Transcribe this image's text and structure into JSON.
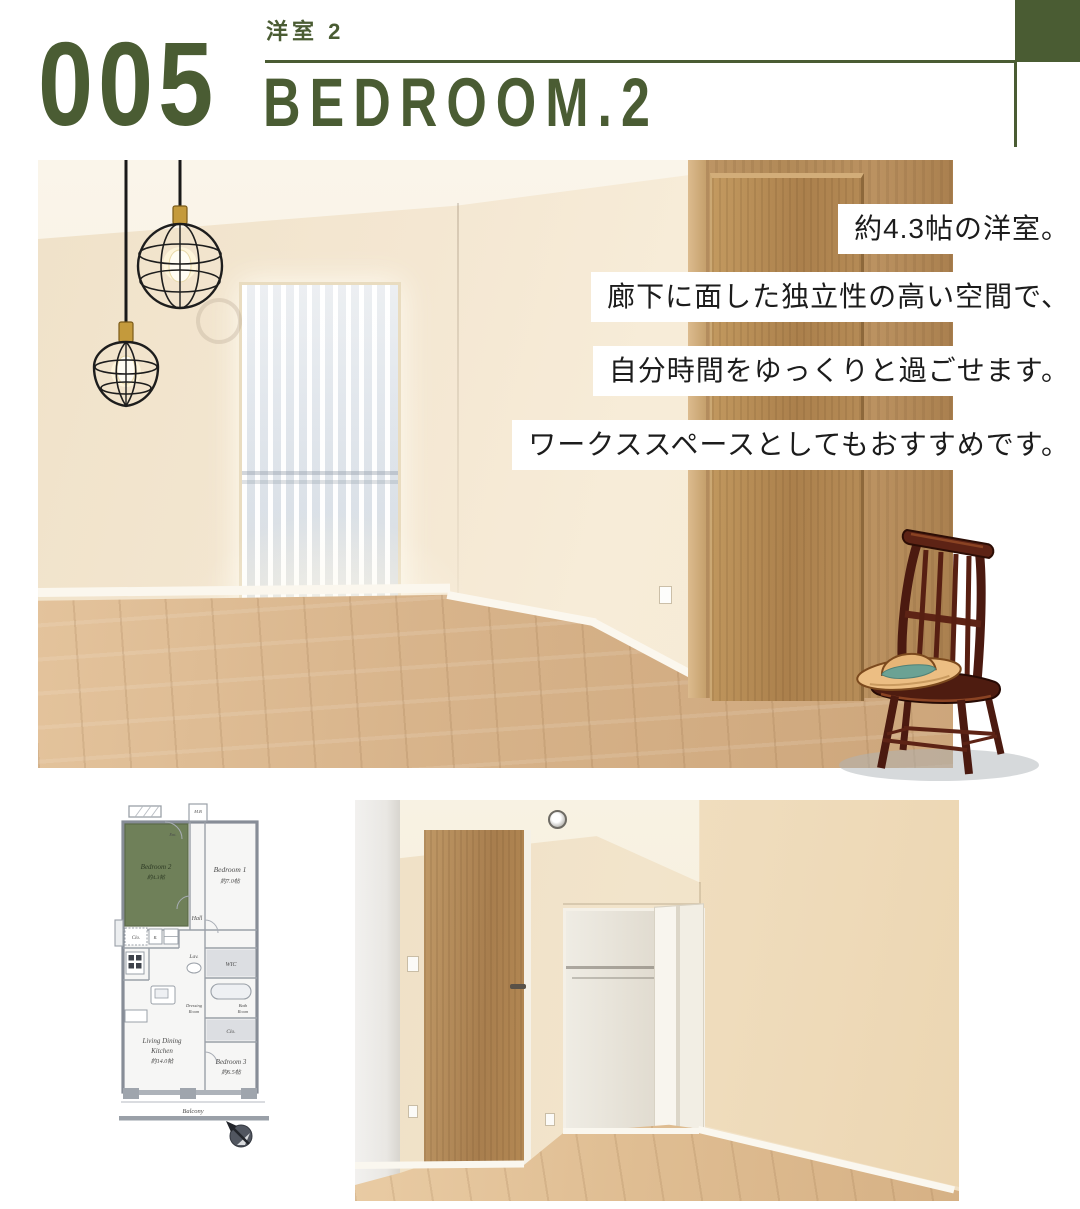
{
  "header": {
    "number": "005",
    "subtitle_jp": "洋室 2",
    "title_en": "BEDROOM.2",
    "accent_color": "#4a5c33"
  },
  "captions": {
    "lines": [
      "約4.3帖の洋室。",
      "廊下に面した独立性の高い空間で、",
      "自分時間をゆっくりと過ごせます。",
      "ワークススペースとしてもおすすめです。"
    ]
  },
  "floorplan": {
    "bedroom2_name": "Bedroom 2",
    "bedroom2_size": "約4.3帖",
    "bedroom1_name": "Bedroom 1",
    "bedroom1_size": "約7.0帖",
    "bedroom3_name": "Bedroom 3",
    "bedroom3_size": "約6.5帖",
    "ldk_name_1": "Living Dining",
    "ldk_name_2": "Kitchen",
    "ldk_size": "約14.0帖",
    "hall": "Hall",
    "lav": "Lav.",
    "wic": "WIC",
    "bath_1": "Bath",
    "bath_2": "Room",
    "dressing_1": "Dressing",
    "dressing_2": "Room",
    "clo_a": "Clo.",
    "clo_b": "Clo.",
    "r_box": "R.",
    "mb": "M.B",
    "ent": "Ent.",
    "balcony": "Balcony",
    "highlight_color": "#6f8059"
  },
  "illustrations": {
    "pendant_lights": "pendant-lights-illustration",
    "chair_with_hat": "chair-with-straw-hat-illustration",
    "compass": "compass-north-icon"
  },
  "colors": {
    "accent_green": "#4a5c33",
    "plan_highlight_green": "#6f8059",
    "wall_beige": "#f3e6d0",
    "floor_wood": "#d7b78e",
    "door_wood": "#b0895a",
    "caption_bg": "#ffffff",
    "caption_text": "#1c1c1c"
  }
}
